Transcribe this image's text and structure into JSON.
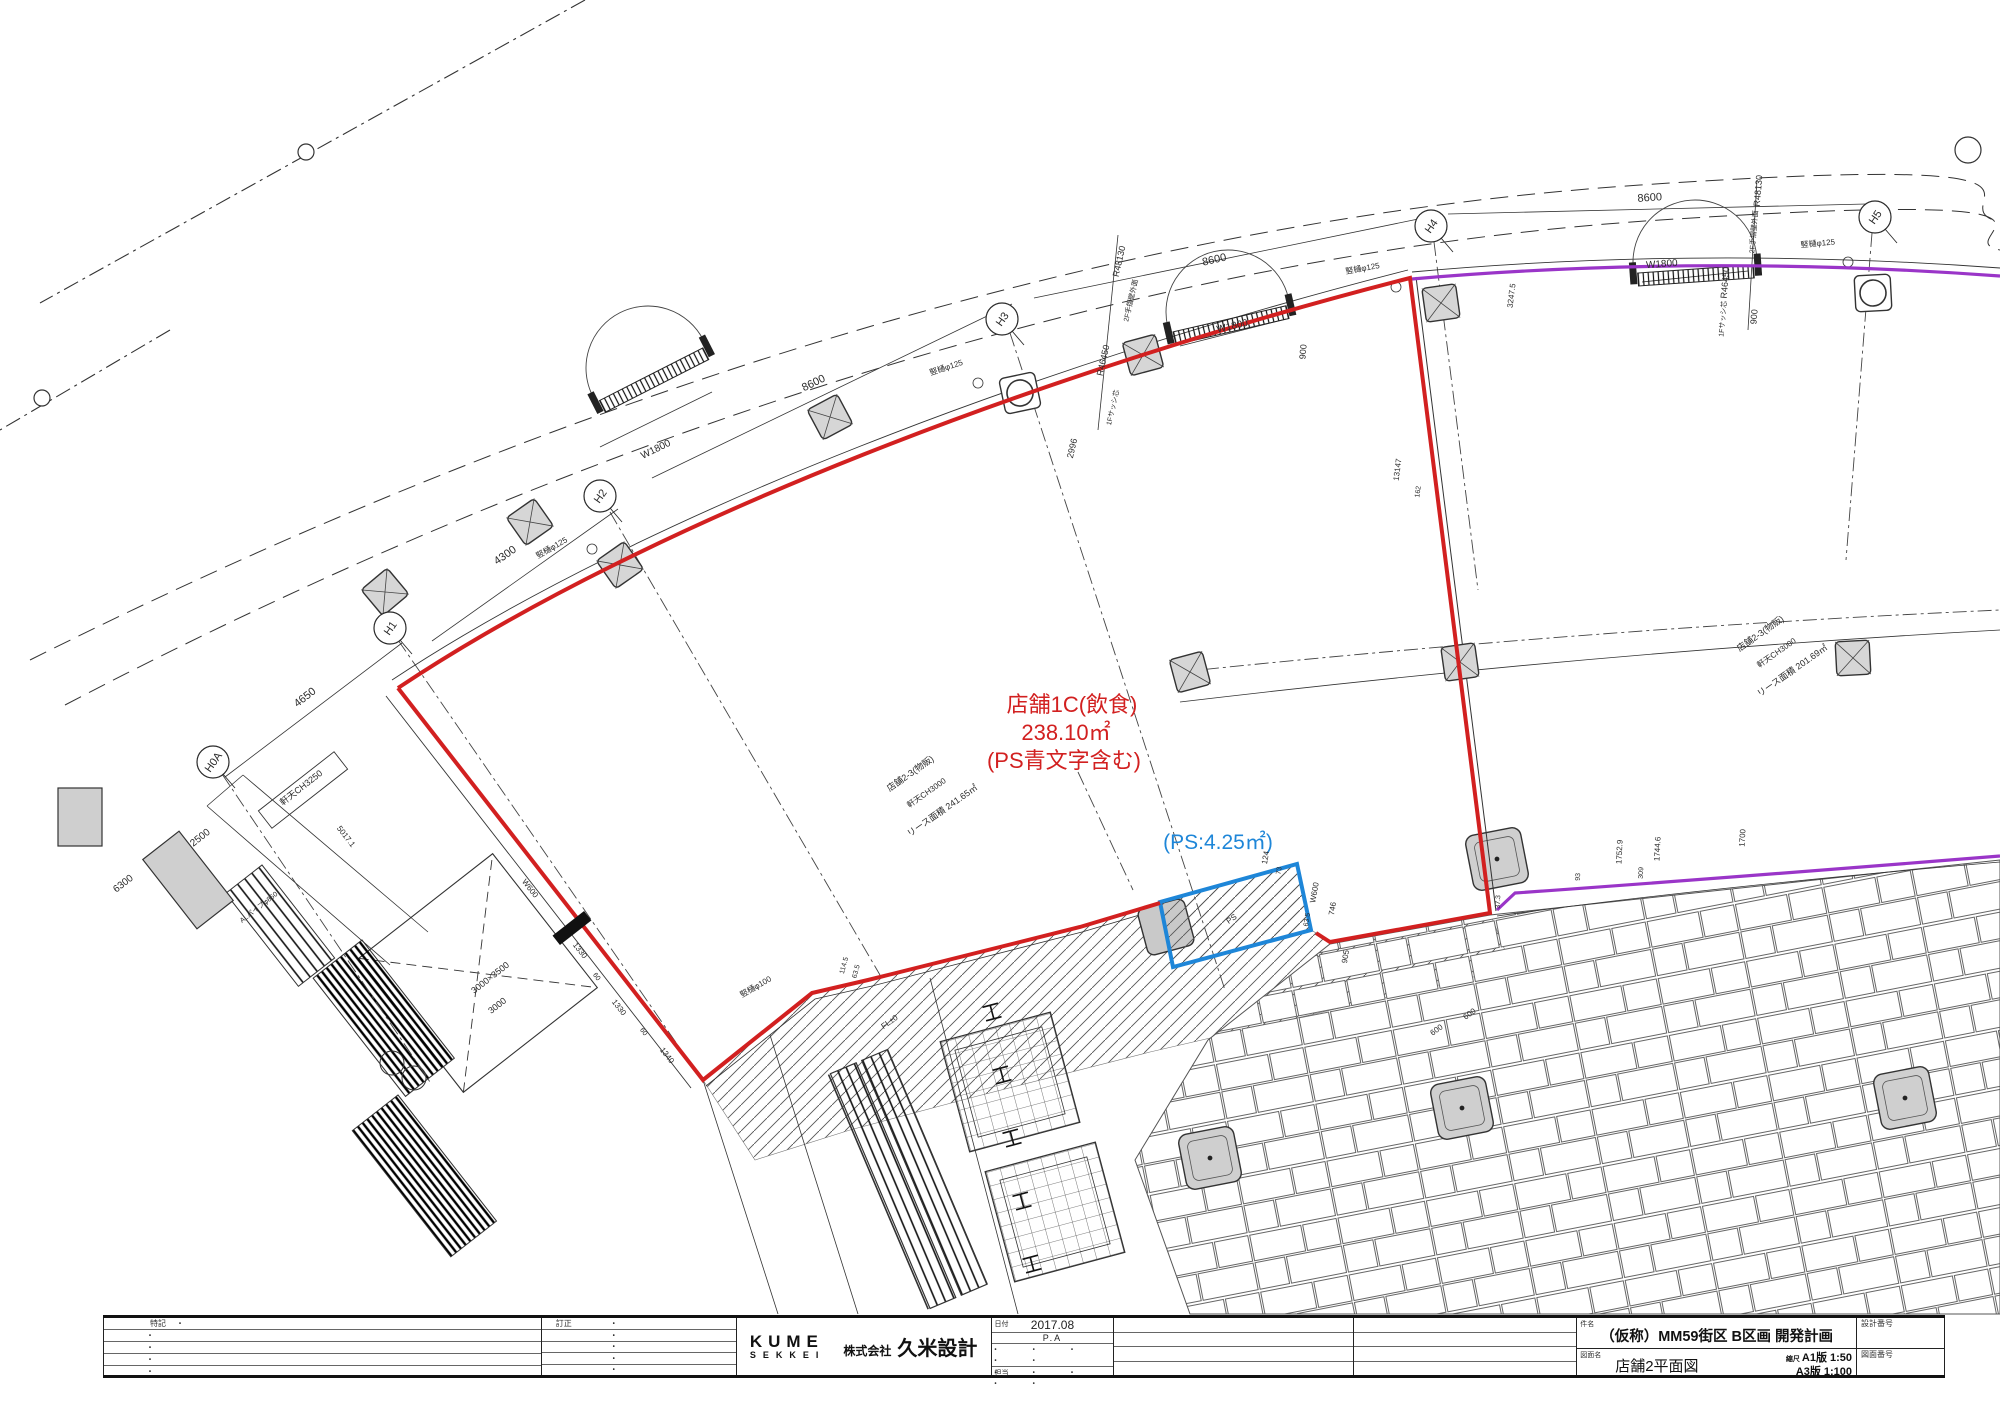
{
  "colors": {
    "red": "#d22020",
    "blue": "#1e86d8",
    "purple": "#9a35c8",
    "ink": "#2a2a2a",
    "gray_fill": "#cfcfcf"
  },
  "drawing": {
    "grid_bubbles": [
      {
        "label": "H0A",
        "x": 213,
        "y": 762
      },
      {
        "label": "H1",
        "x": 390,
        "y": 628
      },
      {
        "label": "H2",
        "x": 600,
        "y": 496
      },
      {
        "label": "H3",
        "x": 1002,
        "y": 319
      },
      {
        "label": "H4",
        "x": 1431,
        "y": 226
      },
      {
        "label": "H5",
        "x": 1875,
        "y": 217
      }
    ],
    "texts": [
      {
        "t": "店舗1C(飲食)",
        "x": 1072,
        "y": 712,
        "r": 0,
        "s": 22,
        "c": "red"
      },
      {
        "t": "238.10㎡",
        "x": 1066,
        "y": 740,
        "r": 0,
        "s": 22,
        "c": "red"
      },
      {
        "t": "(PS青文字含む)",
        "x": 1064,
        "y": 768,
        "r": 0,
        "s": 22,
        "c": "red"
      },
      {
        "t": "(PS:4.25㎡)",
        "x": 1218,
        "y": 849,
        "r": 0,
        "s": 21,
        "c": "blue"
      },
      {
        "t": "店舗2-3(物販)",
        "x": 912,
        "y": 776,
        "r": -35,
        "s": 9
      },
      {
        "t": "軒天CH3000",
        "x": 928,
        "y": 795,
        "r": -35,
        "s": 8
      },
      {
        "t": "リース面積 241.65㎡",
        "x": 944,
        "y": 813,
        "r": -35,
        "s": 9
      },
      {
        "t": "店舗2-3(物販)",
        "x": 1762,
        "y": 636,
        "r": -35,
        "s": 9
      },
      {
        "t": "軒天CH3000",
        "x": 1778,
        "y": 655,
        "r": -35,
        "s": 8
      },
      {
        "t": "リース面積 201.69㎡",
        "x": 1794,
        "y": 673,
        "r": -35,
        "s": 9
      },
      {
        "t": "4650",
        "x": 307,
        "y": 700,
        "r": -38,
        "s": 11
      },
      {
        "t": "4300",
        "x": 507,
        "y": 558,
        "r": -35,
        "s": 11
      },
      {
        "t": "8600",
        "x": 815,
        "y": 386,
        "r": -26,
        "s": 11
      },
      {
        "t": "8600",
        "x": 1215,
        "y": 263,
        "r": -13,
        "s": 11
      },
      {
        "t": "8600",
        "x": 1650,
        "y": 201,
        "r": -4,
        "s": 11
      },
      {
        "t": "W1800",
        "x": 657,
        "y": 452,
        "r": -26,
        "s": 10
      },
      {
        "t": "W1800",
        "x": 1233,
        "y": 329,
        "r": -13,
        "s": 10
      },
      {
        "t": "W1800",
        "x": 1662,
        "y": 267,
        "r": -4,
        "s": 10
      },
      {
        "t": "2500",
        "x": 202,
        "y": 840,
        "r": -38,
        "s": 10
      },
      {
        "t": "6300",
        "x": 125,
        "y": 886,
        "r": -38,
        "s": 10
      },
      {
        "t": "R48130",
        "x": 1122,
        "y": 262,
        "r": -77,
        "s": 9
      },
      {
        "t": "2F手摺壁外面",
        "x": 1133,
        "y": 301,
        "r": -77,
        "s": 7
      },
      {
        "t": "R46450",
        "x": 1106,
        "y": 361,
        "r": -77,
        "s": 9
      },
      {
        "t": "1Fサッシ芯",
        "x": 1115,
        "y": 408,
        "r": -77,
        "s": 7
      },
      {
        "t": "2996",
        "x": 1075,
        "y": 449,
        "r": -77,
        "s": 9
      },
      {
        "t": "900",
        "x": 1306,
        "y": 352,
        "r": -85,
        "s": 9
      },
      {
        "t": "R48130",
        "x": 1761,
        "y": 191,
        "r": -85,
        "s": 9
      },
      {
        "t": "2F手摺壁外面",
        "x": 1756,
        "y": 232,
        "r": -85,
        "s": 7
      },
      {
        "t": "R46450",
        "x": 1728,
        "y": 283,
        "r": -85,
        "s": 9
      },
      {
        "t": "1Fサッシ芯",
        "x": 1725,
        "y": 319,
        "r": -85,
        "s": 7
      },
      {
        "t": "900",
        "x": 1757,
        "y": 317,
        "r": -85,
        "s": 9
      },
      {
        "t": "竪樋φ125",
        "x": 553,
        "y": 550,
        "r": -30,
        "s": 8
      },
      {
        "t": "竪樋φ125",
        "x": 947,
        "y": 370,
        "r": -18,
        "s": 8
      },
      {
        "t": "竪樋φ125",
        "x": 1363,
        "y": 271,
        "r": -10,
        "s": 8
      },
      {
        "t": "竪樋φ125",
        "x": 1818,
        "y": 246,
        "r": -5,
        "s": 8
      },
      {
        "t": "竪樋φ100",
        "x": 757,
        "y": 989,
        "r": -30,
        "s": 8
      },
      {
        "t": "軒天CH3250",
        "x": 303,
        "y": 790,
        "r": -38,
        "s": 9
      },
      {
        "t": "13147",
        "x": 1400,
        "y": 470,
        "r": -83,
        "s": 8
      },
      {
        "t": "162",
        "x": 1420,
        "y": 492,
        "r": -83,
        "s": 7
      },
      {
        "t": "3247.5",
        "x": 1514,
        "y": 296,
        "r": -83,
        "s": 8
      },
      {
        "t": "1752.9",
        "x": 1622,
        "y": 852,
        "r": -87,
        "s": 8
      },
      {
        "t": "1744.6",
        "x": 1660,
        "y": 849,
        "r": -87,
        "s": 8
      },
      {
        "t": "309",
        "x": 1643,
        "y": 873,
        "r": -87,
        "s": 7
      },
      {
        "t": "93",
        "x": 1580,
        "y": 877,
        "r": -87,
        "s": 7
      },
      {
        "t": "W600",
        "x": 1317,
        "y": 893,
        "r": -80,
        "s": 8
      },
      {
        "t": "746",
        "x": 1335,
        "y": 909,
        "r": -80,
        "s": 8
      },
      {
        "t": "63.5",
        "x": 1309,
        "y": 920,
        "r": -80,
        "s": 7
      },
      {
        "t": "905",
        "x": 1348,
        "y": 957,
        "r": -80,
        "s": 8
      },
      {
        "t": "124",
        "x": 1268,
        "y": 858,
        "r": -80,
        "s": 8
      },
      {
        "t": "73",
        "x": 1281,
        "y": 871,
        "r": -80,
        "s": 7
      },
      {
        "t": "37.3",
        "x": 1500,
        "y": 902,
        "r": -87,
        "s": 7
      },
      {
        "t": "114.5",
        "x": 846,
        "y": 966,
        "r": -75,
        "s": 7
      },
      {
        "t": "63.5",
        "x": 858,
        "y": 972,
        "r": -75,
        "s": 7
      },
      {
        "t": "FL±0",
        "x": 891,
        "y": 1024,
        "r": -35,
        "s": 8
      },
      {
        "t": "PS",
        "x": 1233,
        "y": 921,
        "r": -35,
        "s": 8
      },
      {
        "t": "1330",
        "x": 578,
        "y": 952,
        "r": 52,
        "s": 8
      },
      {
        "t": "60",
        "x": 595,
        "y": 978,
        "r": 52,
        "s": 7
      },
      {
        "t": "1330",
        "x": 617,
        "y": 1009,
        "r": 52,
        "s": 8
      },
      {
        "t": "60",
        "x": 642,
        "y": 1033,
        "r": 52,
        "s": 7
      },
      {
        "t": "1340",
        "x": 665,
        "y": 1057,
        "r": 52,
        "s": 8
      },
      {
        "t": "3000×3500",
        "x": 492,
        "y": 980,
        "r": -38,
        "s": 9
      },
      {
        "t": "3000",
        "x": 499,
        "y": 1008,
        "r": -38,
        "s": 9
      },
      {
        "t": "W600",
        "x": 528,
        "y": 890,
        "r": 52,
        "s": 8
      },
      {
        "t": "600",
        "x": 1438,
        "y": 1032,
        "r": -35,
        "s": 8
      },
      {
        "t": "600",
        "x": 1471,
        "y": 1016,
        "r": -35,
        "s": 8
      },
      {
        "t": "5017.1",
        "x": 344,
        "y": 838,
        "r": 52,
        "s": 8
      },
      {
        "t": "ALパイプφ850",
        "x": 260,
        "y": 909,
        "r": -38,
        "s": 7
      },
      {
        "t": "1700",
        "x": 1745,
        "y": 838,
        "r": -87,
        "s": 8
      }
    ]
  },
  "title_block": {
    "notes_label": "特記",
    "revision_label": "訂正",
    "dot": "・",
    "dots_row": "・ ・ ・ ・ ・",
    "logo_top": "KUME",
    "logo_bottom": "SEKKEI",
    "company_prefix": "株式会社",
    "company": "久米設計",
    "date_label": "日付",
    "date_value": "2017.08",
    "date_sub": "P.A",
    "staff_label": "担当",
    "project_label": "件名",
    "project_value": "（仮称）MM59街区 B区画 開発計画",
    "drawing_label": "図面名",
    "drawing_value": "店舗2平面図",
    "scale_label": "縮尺",
    "scale_a1": "A1版  1:50",
    "scale_a3": "A3版  1:100",
    "design_no_label": "設計番号",
    "drawing_no_label": "図面番号"
  }
}
